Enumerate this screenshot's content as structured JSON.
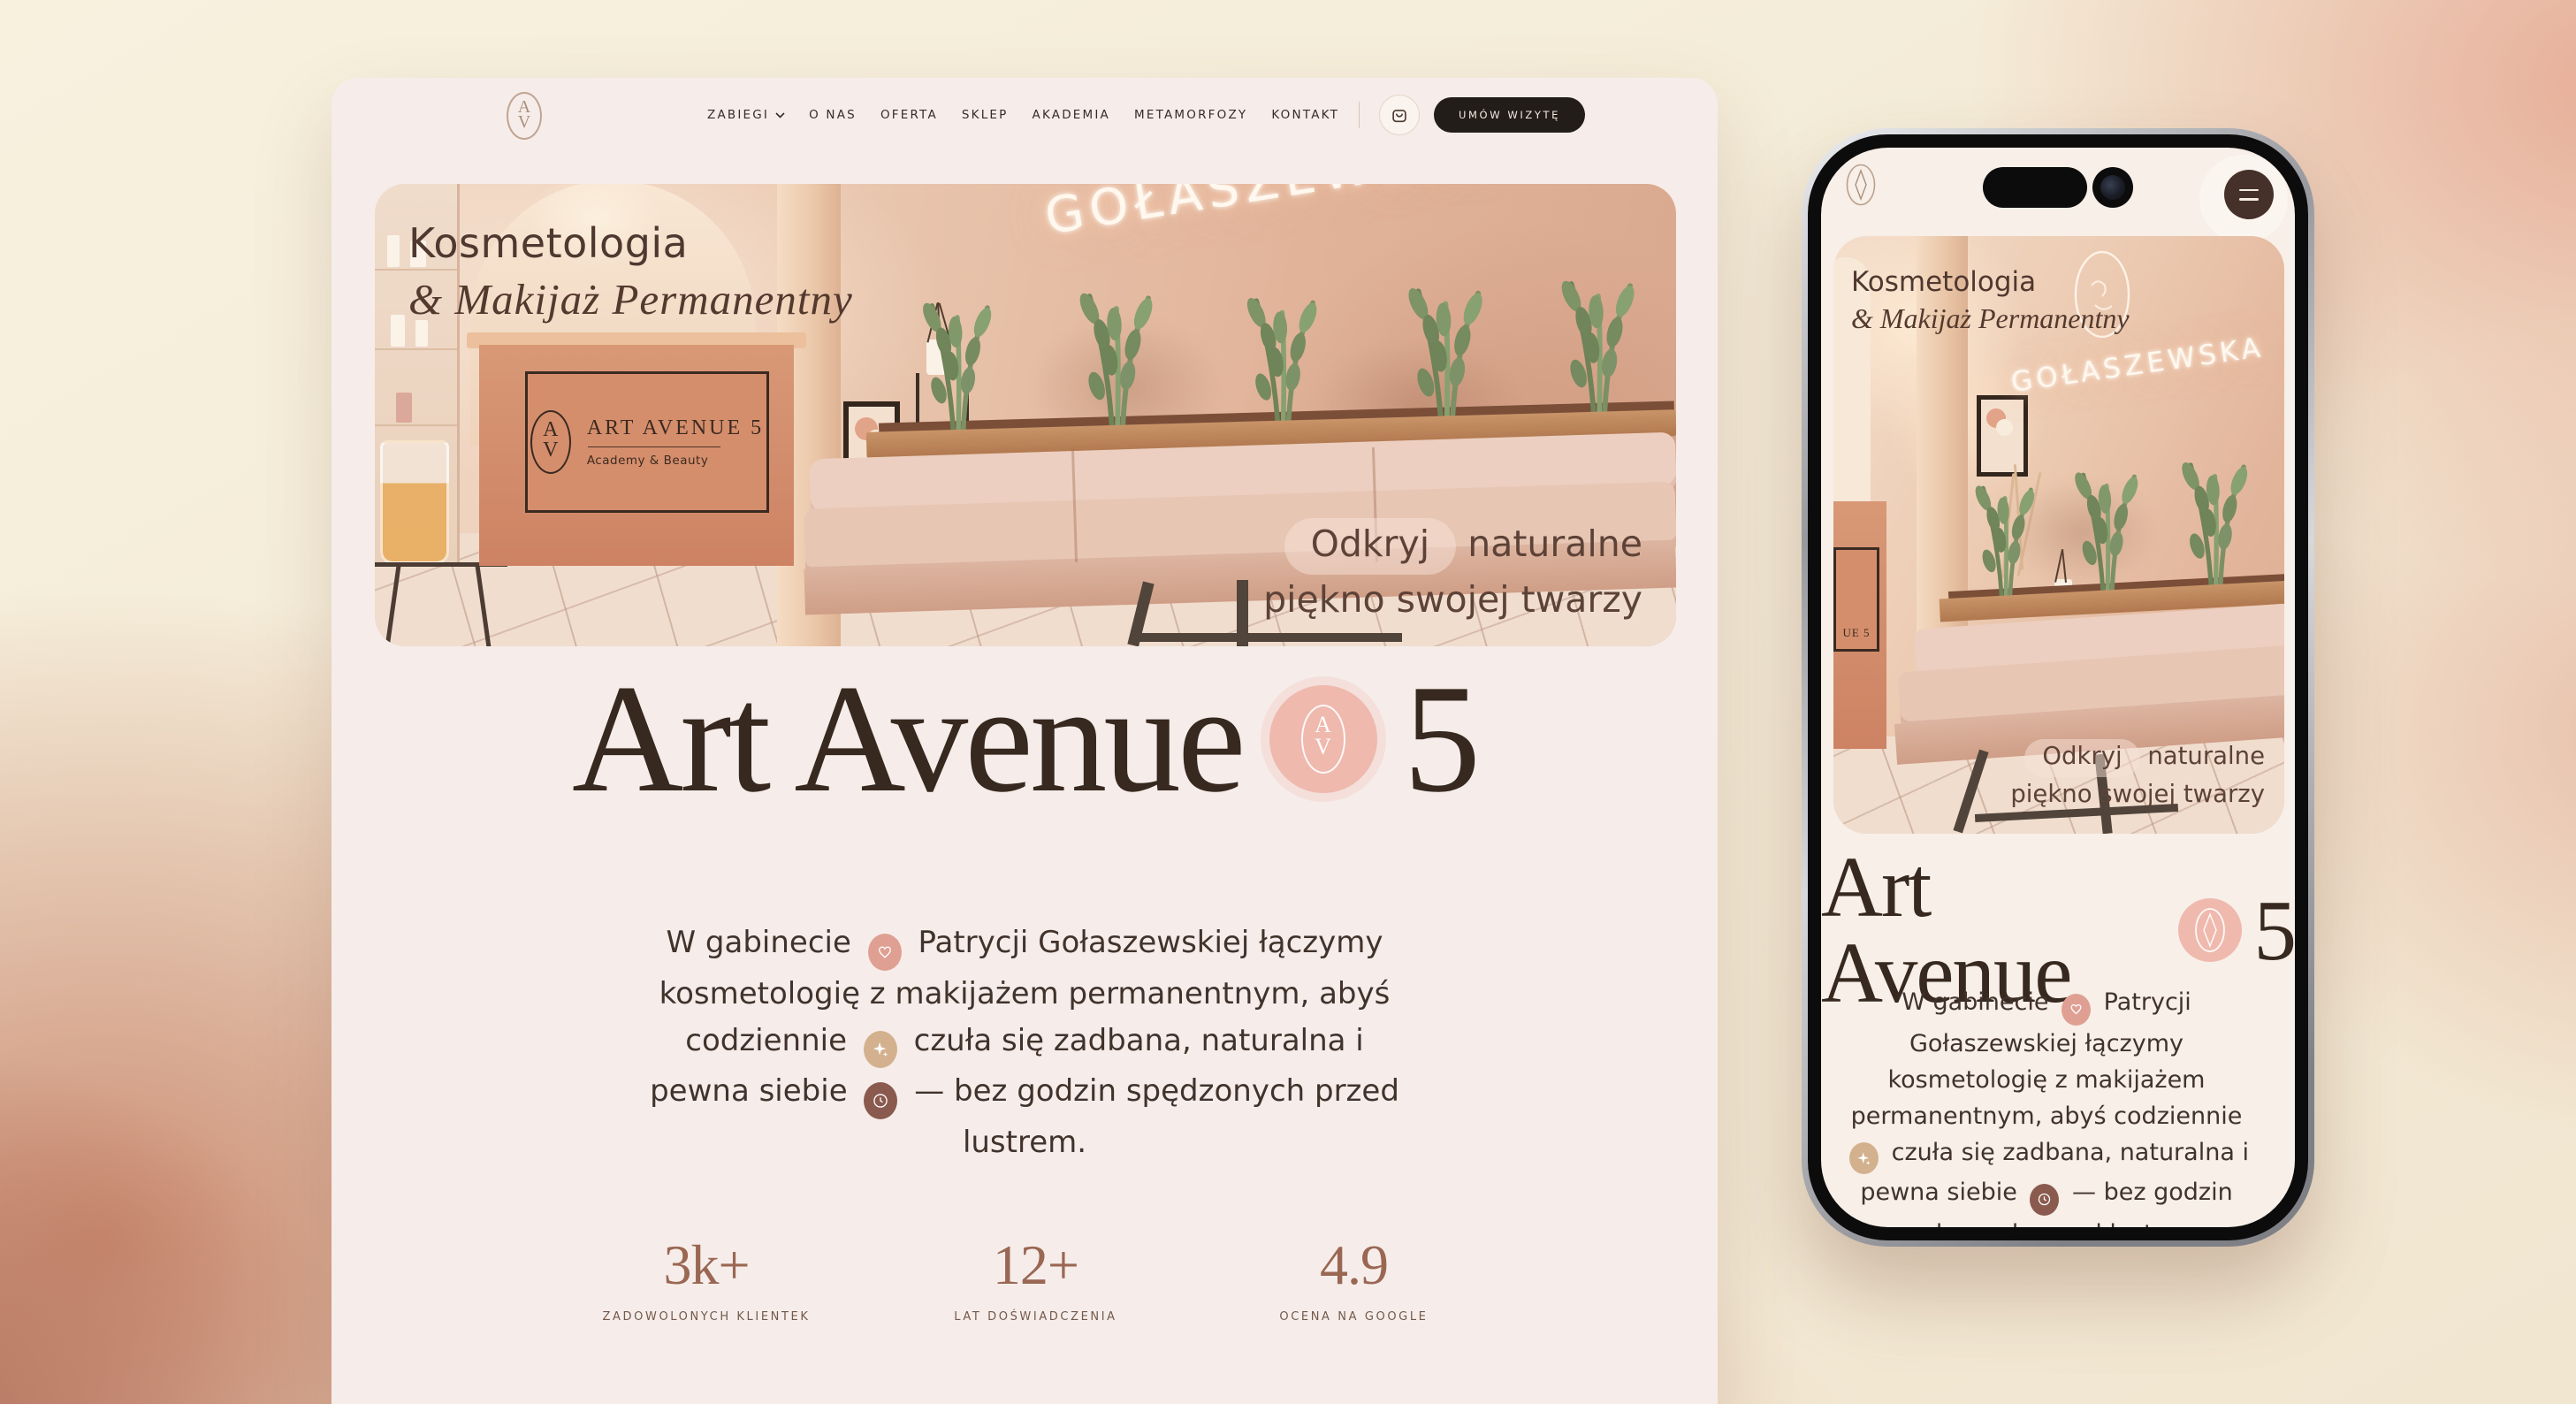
{
  "brand": {
    "monogram_top": "A",
    "monogram_bottom": "V"
  },
  "nav": {
    "menu": [
      {
        "label": "ZABIEGI",
        "has_dropdown": true
      },
      {
        "label": "O NAS"
      },
      {
        "label": "OFERTA"
      },
      {
        "label": "SKLEP"
      },
      {
        "label": "AKADEMIA"
      },
      {
        "label": "METAMORFOZY"
      },
      {
        "label": "KONTAKT"
      }
    ],
    "cta_label": "UMÓW WIZYTĘ"
  },
  "hero": {
    "heading_line1": "Kosmetologia",
    "heading_line2": "& Makijaż Permanentny",
    "neon_sign": "GOŁASZEWSKA",
    "desk_sign": {
      "title": "ART AVENUE 5",
      "subtitle": "Academy & Beauty",
      "mobile_fragment": "UE 5"
    },
    "overlay": {
      "word_highlight": "Odkryj",
      "word_rest": "naturalne",
      "line2": "piękno swojej twarzy"
    }
  },
  "title": {
    "part1": "Art Avenue",
    "part2": "5"
  },
  "paragraph": {
    "seg1": "W gabinecie",
    "seg2": "Patrycji Gołaszewskiej łączymy kosmetologię z makijażem permanentnym, abyś codziennie",
    "seg3": "czuła się zadbana, naturalna i pewna siebie",
    "seg4": "— bez godzin spędzonych przed lustrem.",
    "badges": [
      {
        "icon": "heart-icon",
        "color": "#dfa093"
      },
      {
        "icon": "sparkle-icon",
        "color": "#d3b18e"
      },
      {
        "icon": "clock-icon",
        "color": "#8a5a4e"
      }
    ]
  },
  "stats": [
    {
      "value": "3k+",
      "label": "ZADOWOLONYCH KLIENTEK"
    },
    {
      "value": "12+",
      "label": "LAT DOŚWIADCZENIA"
    },
    {
      "value": "4.9",
      "label": "OCENA NA GOOGLE"
    }
  ],
  "theme": {
    "page_cream": "#f5efdc",
    "terracotta": "#c9876d",
    "card_bg": "#f6edea",
    "text_dark": "#41332c",
    "title_brown": "#37291f",
    "accent_pink_circle": "#efb9ae",
    "stat_number": "#9a6753",
    "cta_bg": "#231d19"
  }
}
